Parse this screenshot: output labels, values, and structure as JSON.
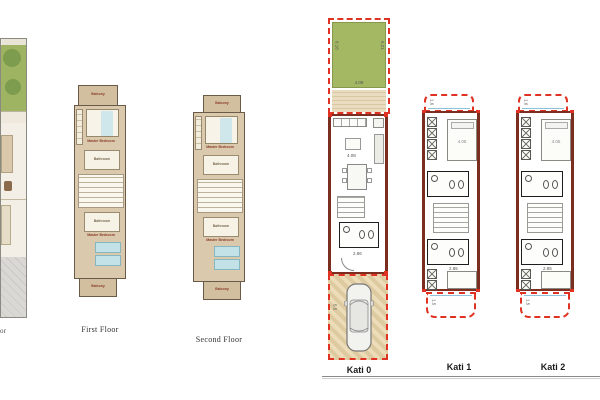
{
  "canvas": {
    "width": 600,
    "height": 400,
    "background": "#ffffff"
  },
  "colors": {
    "garden_green": "#a4b763",
    "outline_red": "#e03222",
    "wall_maroon": "#7b2d20",
    "plan_beige": "#dbc9ad",
    "balcony_beige": "#d2bf9f",
    "bed_teal": "#c2e2e8",
    "paving_gray": "#d9d8d4",
    "glass_blue": "#8fc3dc"
  },
  "ground_floor_partial": {
    "label_fragment": "or"
  },
  "first_floor": {
    "label": "First Floor",
    "rooms": {
      "balcony_top": "Balcony",
      "master_bedroom_top": "Master Bedroom",
      "bathroom_top": "Bathroom",
      "bathroom_bottom": "Bathroom",
      "master_bedroom_bottom": "Master Bedroom",
      "balcony_bottom": "Balcony"
    }
  },
  "second_floor": {
    "label": "Second Floor",
    "rooms": {
      "balcony_top": "Balcony",
      "master_bedroom_top": "Master Bedroom",
      "bathroom_top": "Bathroom",
      "bathroom_bottom": "Bathroom",
      "master_bedroom_bottom": "Master Bedroom",
      "balcony_bottom": "Balcony"
    }
  },
  "kati_0": {
    "label": "Kati 0",
    "garden_dims": {
      "left": "6.16",
      "right": "6.21",
      "bottom": "4.08"
    },
    "living_dim": "4.08",
    "hall_dim": "2.86",
    "garage_dim": "5.5"
  },
  "kati_1": {
    "label": "Kati 1",
    "balcony_top_dim": "1.6",
    "bedroom_top_dim": "4.05",
    "hall_dim": "2.85",
    "balcony_bottom_dim": "1.5"
  },
  "kati_2": {
    "label": "Kati 2",
    "balcony_top_dim": "1.6",
    "bedroom_top_dim": "4.05",
    "hall_dim": "2.85",
    "balcony_bottom_dim": "1.5"
  }
}
